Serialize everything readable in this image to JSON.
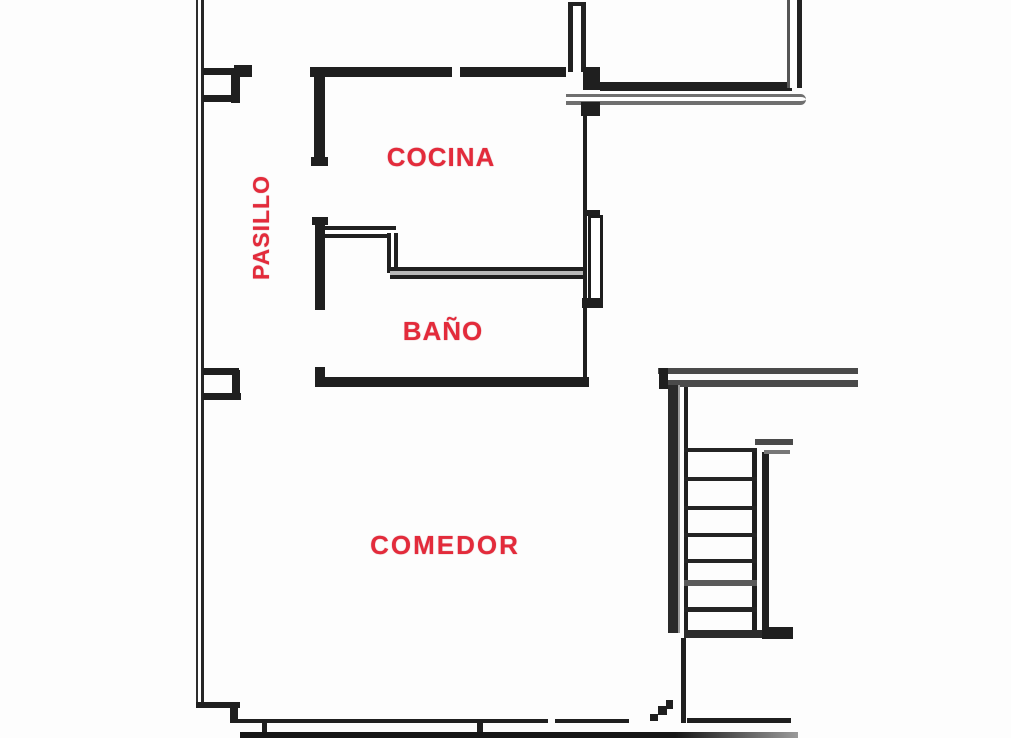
{
  "plan": {
    "background_color": "#fdfdfd",
    "wall_color": "#1f1f1f",
    "label_color": "#e32b3b",
    "rooms": {
      "pasillo": {
        "label": "PASILLO",
        "orientation": "vertical"
      },
      "cocina": {
        "label": "COCINA",
        "orientation": "horizontal"
      },
      "bano": {
        "label": "BAÑO",
        "orientation": "horizontal"
      },
      "comedor": {
        "label": "COMEDOR",
        "orientation": "horizontal"
      }
    },
    "staircase": {
      "treads_visible": 8
    },
    "doors_visible": 1
  }
}
